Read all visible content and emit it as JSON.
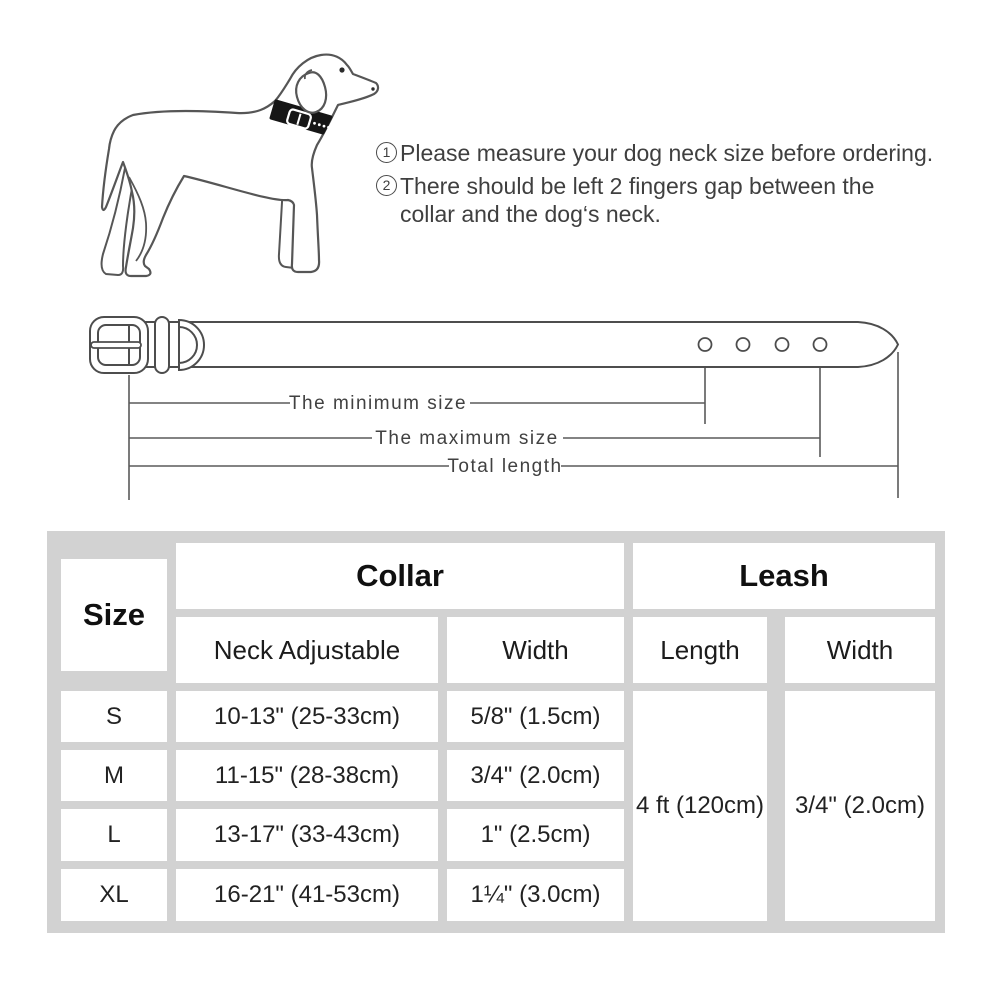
{
  "instructions": {
    "items": [
      {
        "num": "1",
        "text": "Please measure your dog neck size before ordering."
      },
      {
        "num": "2",
        "text": "There should be left 2 fingers gap between the\ncollar and the dog‘s neck."
      }
    ]
  },
  "diagram": {
    "labels": {
      "min": "The minimum size",
      "max": "The maximum size",
      "total": "Total length"
    }
  },
  "size_table": {
    "header": {
      "size": "Size",
      "collar": "Collar",
      "leash": "Leash",
      "neck": "Neck Adjustable",
      "collar_width": "Width",
      "leash_length": "Length",
      "leash_width": "Width"
    },
    "rows": [
      {
        "size": "S",
        "neck": "10-13\" (25-33cm)",
        "width": "5/8\" (1.5cm)"
      },
      {
        "size": "M",
        "neck": "11-15\" (28-38cm)",
        "width": "3/4\" (2.0cm)"
      },
      {
        "size": "L",
        "neck": "13-17\" (33-43cm)",
        "width": "1\" (2.5cm)"
      },
      {
        "size": "XL",
        "neck": "16-21\" (41-53cm)",
        "width": "1¼\" (3.0cm)"
      }
    ],
    "leash": {
      "length": "4 ft (120cm)",
      "width": "3/4\" (2.0cm)"
    }
  },
  "colors": {
    "table_background": "#d2d2d2",
    "cell_background": "#ffffff",
    "line_art": "#4d4d4d",
    "text": "#3f3f3f",
    "collar_band": "#161616"
  }
}
